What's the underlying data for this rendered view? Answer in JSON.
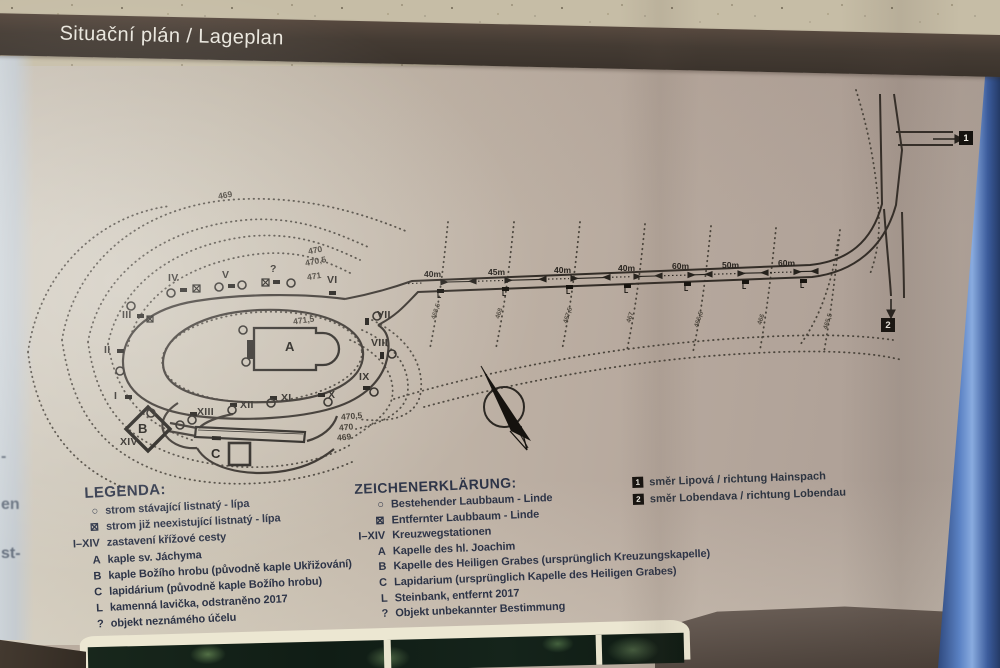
{
  "header": {
    "title": "Situační plán / Lageplan"
  },
  "colors": {
    "band": "#443b33",
    "panel": "#bfb3a6",
    "legend_ink": "#2d3447",
    "map_ink": "#2f2a26",
    "frame_blue": "#5b82c4"
  },
  "map": {
    "stations": [
      {
        "x": 114,
        "y": 390,
        "l": "I"
      },
      {
        "x": 104,
        "y": 344,
        "l": "II"
      },
      {
        "x": 122,
        "y": 309,
        "l": "III"
      },
      {
        "x": 168,
        "y": 272,
        "l": "IV"
      },
      {
        "x": 222,
        "y": 269,
        "l": "V"
      },
      {
        "x": 270,
        "y": 263,
        "l": "?"
      },
      {
        "x": 327,
        "y": 274,
        "l": "VI"
      },
      {
        "x": 377,
        "y": 309,
        "l": "VII"
      },
      {
        "x": 371,
        "y": 337,
        "l": "VIII"
      },
      {
        "x": 359,
        "y": 371,
        "l": "IX"
      },
      {
        "x": 328,
        "y": 389,
        "l": "X"
      },
      {
        "x": 281,
        "y": 392,
        "l": "XI"
      },
      {
        "x": 240,
        "y": 399,
        "l": "XII"
      },
      {
        "x": 197,
        "y": 406,
        "l": "XIII"
      },
      {
        "x": 120,
        "y": 436,
        "l": "XIV"
      }
    ],
    "buildings": [
      {
        "x": 285,
        "y": 339,
        "t": "A"
      },
      {
        "x": 138,
        "y": 421,
        "t": "B"
      },
      {
        "x": 211,
        "y": 446,
        "t": "C"
      }
    ],
    "contour_labels": [
      {
        "x": 218,
        "y": 190,
        "r": "-10deg",
        "t": "469"
      },
      {
        "x": 308,
        "y": 245,
        "r": "-11deg",
        "t": "470"
      },
      {
        "x": 305,
        "y": 256,
        "r": "-11deg",
        "t": "470,5"
      },
      {
        "x": 307,
        "y": 271,
        "r": "-9deg",
        "t": "471"
      },
      {
        "x": 293,
        "y": 315,
        "r": "-8deg",
        "t": "471,5"
      },
      {
        "x": 341,
        "y": 411,
        "r": "-5deg",
        "t": "470,5"
      },
      {
        "x": 339,
        "y": 422,
        "r": "-5deg",
        "t": "470"
      },
      {
        "x": 337,
        "y": 432,
        "r": "-5deg",
        "t": "469"
      }
    ],
    "slope_labels": [
      {
        "x": 428,
        "y": 308,
        "t": "468,5"
      },
      {
        "x": 494,
        "y": 310,
        "t": "468"
      },
      {
        "x": 560,
        "y": 312,
        "t": "467,5"
      },
      {
        "x": 625,
        "y": 314,
        "t": "467"
      },
      {
        "x": 691,
        "y": 316,
        "t": "466,5"
      },
      {
        "x": 756,
        "y": 316,
        "t": "466"
      },
      {
        "x": 820,
        "y": 318,
        "t": "465,5"
      }
    ],
    "road_labels": [
      {
        "x": 424,
        "y": 269,
        "t": "40m"
      },
      {
        "x": 488,
        "y": 267,
        "t": "45m"
      },
      {
        "x": 554,
        "y": 265,
        "t": "40m"
      },
      {
        "x": 618,
        "y": 263,
        "t": "40m"
      },
      {
        "x": 672,
        "y": 261,
        "t": "60m"
      },
      {
        "x": 722,
        "y": 260,
        "t": "50m"
      },
      {
        "x": 778,
        "y": 258,
        "t": "60m"
      }
    ],
    "benches": [
      {
        "x": 437,
        "y": 289,
        "l": "L"
      },
      {
        "x": 502,
        "y": 287,
        "l": "L"
      },
      {
        "x": 566,
        "y": 285,
        "l": "L"
      },
      {
        "x": 624,
        "y": 284,
        "l": "L"
      },
      {
        "x": 684,
        "y": 282,
        "l": "L"
      },
      {
        "x": 742,
        "y": 280,
        "l": "L"
      },
      {
        "x": 800,
        "y": 279,
        "l": "L"
      }
    ],
    "destinations": [
      {
        "x": 959,
        "y": 131,
        "n": "1"
      },
      {
        "x": 881,
        "y": 318,
        "n": "2"
      }
    ]
  },
  "legend_cz": {
    "title": "LEGENDA:",
    "items": [
      {
        "sym": "○",
        "text": "strom stávající listnatý - lípa"
      },
      {
        "sym": "⊠",
        "text": "strom již neexistující listnatý - lípa"
      },
      {
        "sym": "I–XIV",
        "text": "zastavení křížové cesty"
      },
      {
        "sym": "A",
        "text": "kaple sv. Jáchyma"
      },
      {
        "sym": "B",
        "text": "kaple Božího hrobu (původně kaple Ukřižování)"
      },
      {
        "sym": "C",
        "text": "lapidárium (původně kaple Božího hrobu)"
      },
      {
        "sym": "L",
        "text": "kamenná lavička, odstraněno 2017"
      },
      {
        "sym": "?",
        "text": "objekt neznámého účelu"
      }
    ]
  },
  "legend_de": {
    "title": "ZEICHENERKLÄRUNG:",
    "items": [
      {
        "sym": "○",
        "text": "Bestehender Laubbaum - Linde"
      },
      {
        "sym": "⊠",
        "text": "Entfernter Laubbaum - Linde"
      },
      {
        "sym": "I–XIV",
        "text": "Kreuzwegstationen"
      },
      {
        "sym": "A",
        "text": "Kapelle des hl. Joachim"
      },
      {
        "sym": "B",
        "text": "Kapelle des Heiligen Grabes (ursprünglich Kreuzungskapelle)"
      },
      {
        "sym": "C",
        "text": "Lapidarium (ursprünglich Kapelle des Heiligen Grabes)"
      },
      {
        "sym": "L",
        "text": "Steinbank, entfernt 2017"
      },
      {
        "sym": "?",
        "text": "Objekt unbekannter Bestimmung"
      }
    ]
  },
  "directions": [
    {
      "n": "1",
      "t": "směr Lipová / richtung Hainspach"
    },
    {
      "n": "2",
      "t": "směr Lobendava / richtung Lobendau"
    }
  ],
  "edge_fragments": [
    {
      "y": 448,
      "t": "-"
    },
    {
      "y": 496,
      "t": "en"
    },
    {
      "y": 545,
      "t": "st-"
    }
  ]
}
